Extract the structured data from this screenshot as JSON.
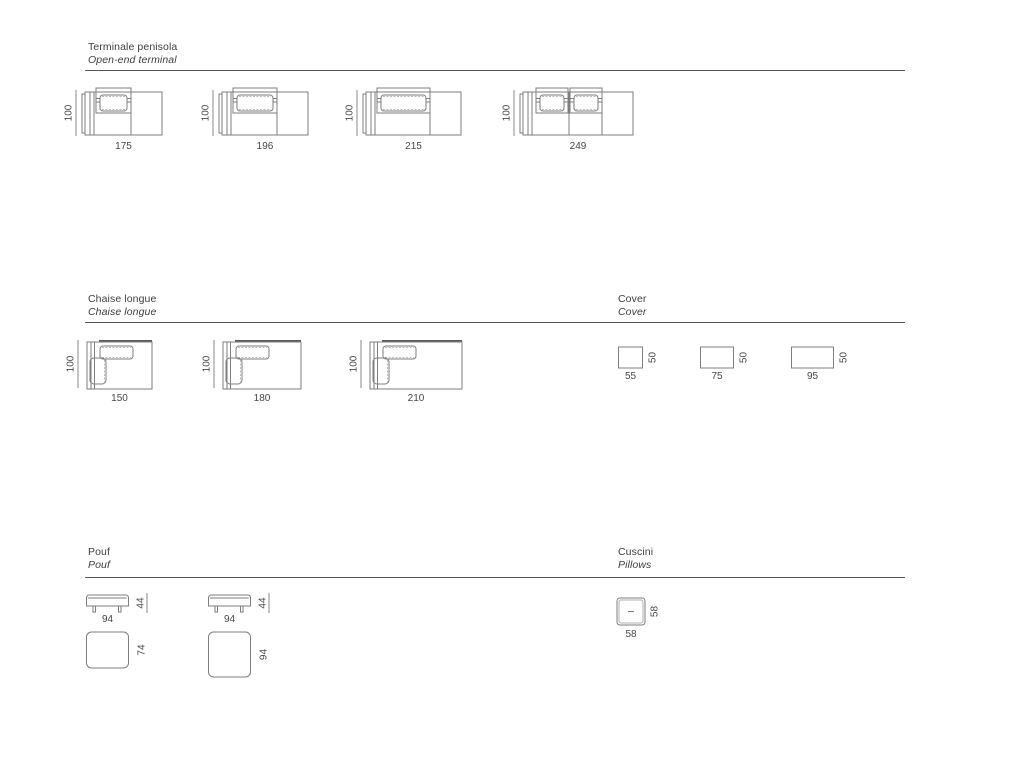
{
  "page": {
    "background": "#ffffff",
    "line_color": "#7e7e7e",
    "rule_color": "#555555",
    "text_color": "#474747"
  },
  "sections": {
    "terminale": {
      "title_it": "Terminale penisola",
      "title_en": "Open-end terminal",
      "items": [
        {
          "width": 175,
          "height": 100,
          "seats": 1,
          "width_label": "175",
          "height_label": "100"
        },
        {
          "width": 196,
          "height": 100,
          "seats": 1,
          "width_label": "196",
          "height_label": "100"
        },
        {
          "width": 215,
          "height": 100,
          "seats": 1,
          "width_label": "215",
          "height_label": "100"
        },
        {
          "width": 249,
          "height": 100,
          "seats": 2,
          "width_label": "249",
          "height_label": "100"
        }
      ]
    },
    "chaise": {
      "title_it": "Chaise longue",
      "title_en": "Chaise longue",
      "items": [
        {
          "width": 150,
          "height": 100,
          "width_label": "150",
          "height_label": "100"
        },
        {
          "width": 180,
          "height": 100,
          "width_label": "180",
          "height_label": "100"
        },
        {
          "width": 210,
          "height": 100,
          "width_label": "210",
          "height_label": "100"
        }
      ]
    },
    "cover": {
      "title_it": "Cover",
      "title_en": "Cover",
      "items": [
        {
          "width": 55,
          "height": 50,
          "width_label": "55",
          "height_label": "50"
        },
        {
          "width": 75,
          "height": 50,
          "width_label": "75",
          "height_label": "50"
        },
        {
          "width": 95,
          "height": 50,
          "width_label": "95",
          "height_label": "50"
        }
      ]
    },
    "pouf": {
      "title_it": "Pouf",
      "title_en": "Pouf",
      "items": [
        {
          "width": 94,
          "height": 44,
          "depth": 74,
          "width_label": "94",
          "height_label": "44",
          "depth_label": "74"
        },
        {
          "width": 94,
          "height": 44,
          "depth": 94,
          "width_label": "94",
          "height_label": "44",
          "depth_label": "94"
        }
      ]
    },
    "cuscini": {
      "title_it": "Cuscini",
      "title_en": "Pillows",
      "items": [
        {
          "width": 58,
          "height": 58,
          "width_label": "58",
          "height_label": "58"
        }
      ]
    }
  }
}
